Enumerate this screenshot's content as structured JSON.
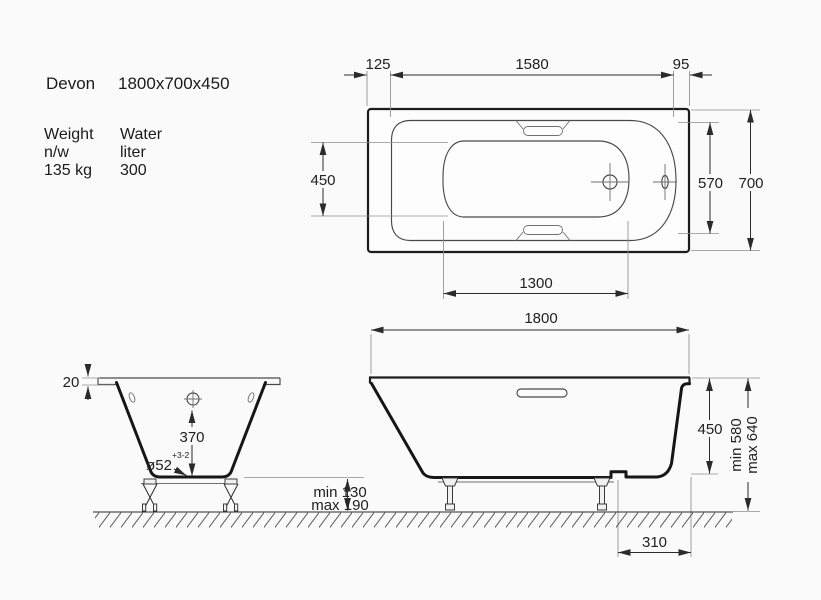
{
  "spec": {
    "model": "Devon",
    "dimensions": "1800x700x450",
    "weight_label": "Weight",
    "weight_unit_label": "n/w",
    "weight_value": "135 kg",
    "water_label": "Water",
    "water_unit_label": "liter",
    "water_value": "300"
  },
  "top_view": {
    "offset_left": "125",
    "rim_opening_length": "1580",
    "offset_right": "95",
    "well_width": "450",
    "well_length": "1300",
    "opening_width": "570",
    "overall_width": "700"
  },
  "front_view": {
    "overall_length": "1800",
    "depth": "450",
    "height_min": "min 580",
    "height_max": "max 640",
    "clearance_min": "min 130",
    "clearance_max": "max 190",
    "drain_offset": "310"
  },
  "end_view": {
    "rim_height": "20",
    "drain_depth": "370",
    "drain_diameter": "ø52",
    "drain_tolerance": "+3-2"
  },
  "colors": {
    "outline": "#161616",
    "dimension": "#2b2b2b",
    "background": "#fafafa"
  }
}
